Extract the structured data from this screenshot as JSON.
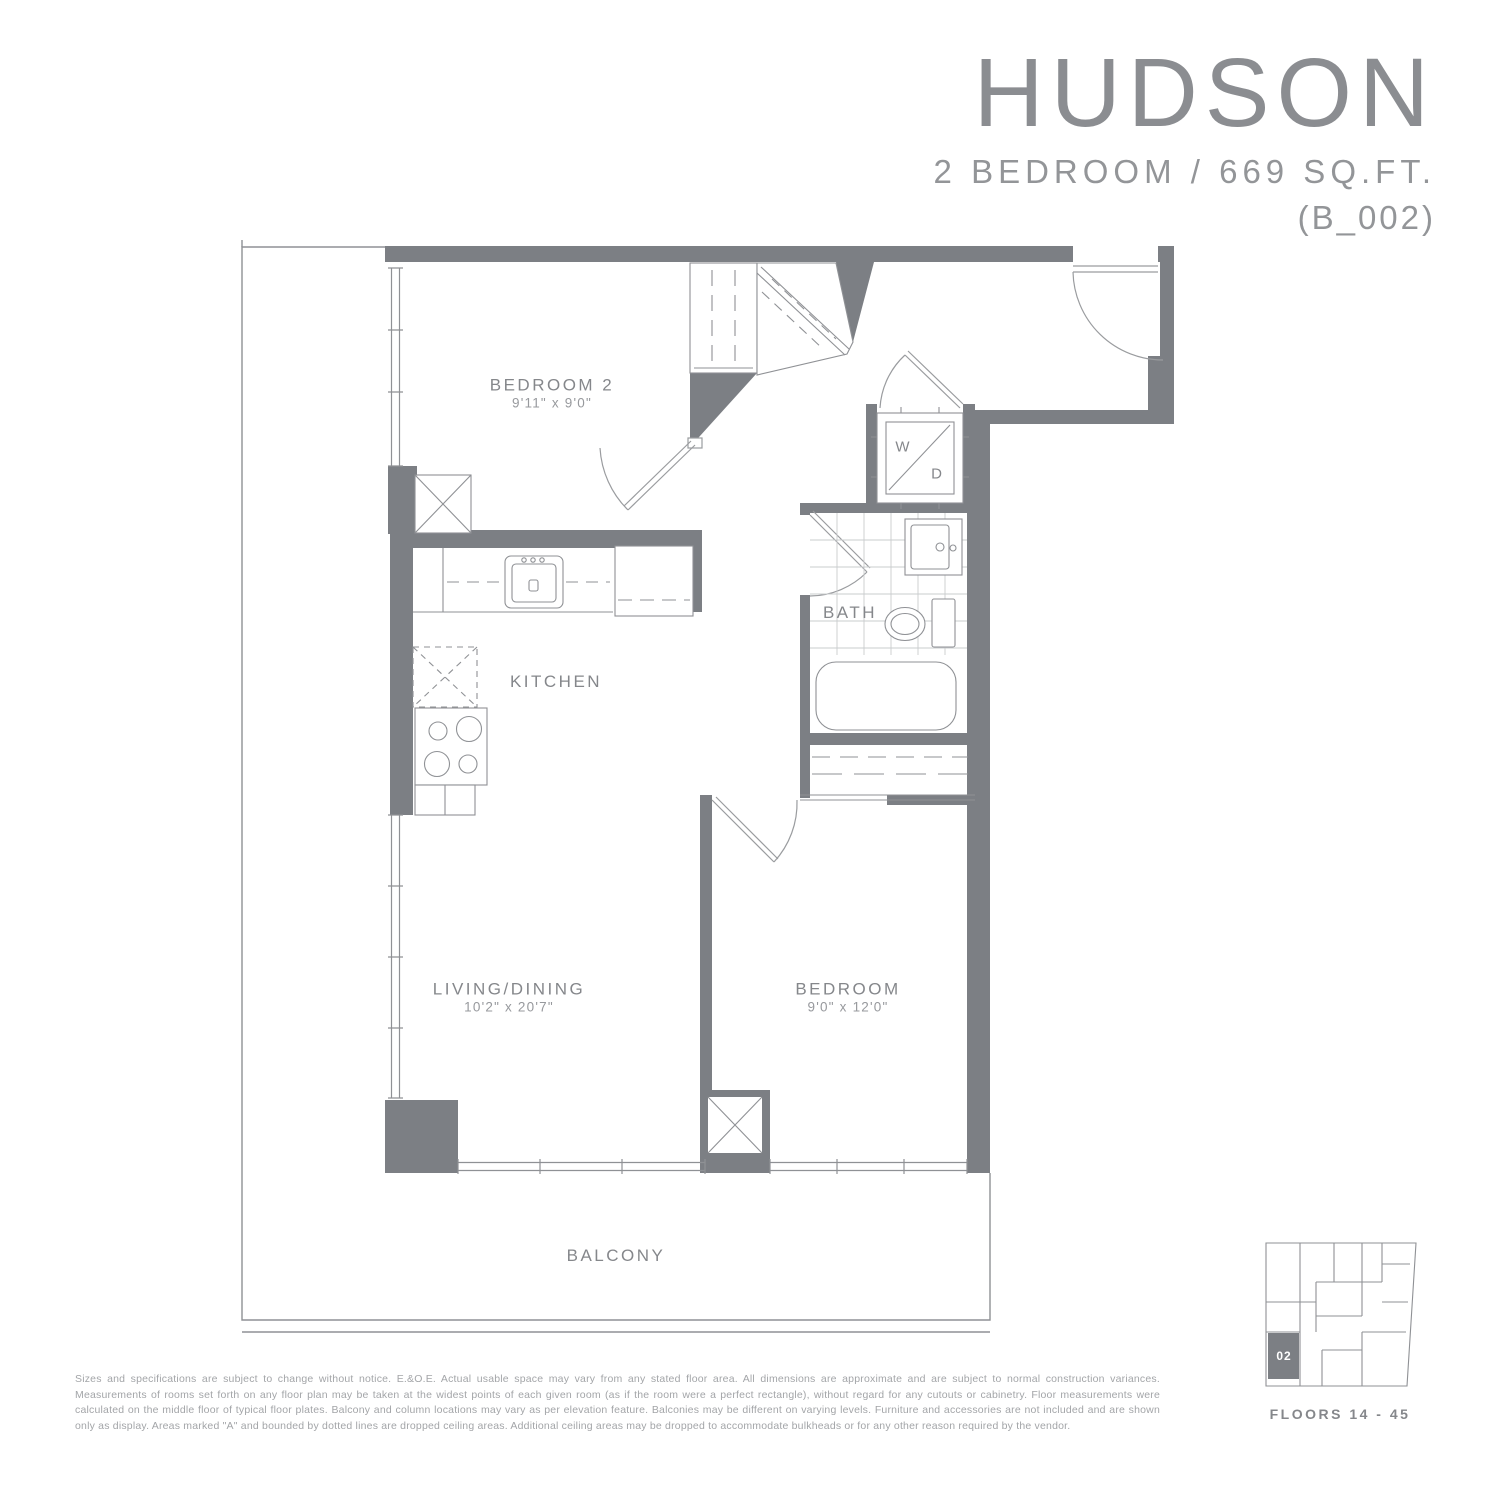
{
  "header": {
    "title": "HUDSON",
    "subtitle": "2 BEDROOM  /  669 SQ.FT.",
    "unit_code": "(B_002)"
  },
  "rooms": {
    "bedroom2": {
      "name": "BEDROOM 2",
      "dims": "9'11\" x 9'0\""
    },
    "kitchen": {
      "name": "KITCHEN"
    },
    "bath": {
      "name": "BATH"
    },
    "living": {
      "name": "LIVING/DINING",
      "dims": "10'2\" x 20'7\""
    },
    "bedroom": {
      "name": "BEDROOM",
      "dims": "9'0\" x 12'0\""
    },
    "balcony": {
      "name": "BALCONY"
    }
  },
  "appliances": {
    "washer": "W",
    "dryer": "D"
  },
  "keyplan": {
    "unit": "02",
    "floors": "FLOORS 14 - 45"
  },
  "disclaimer": "Sizes and specifications are subject to change without notice. E.&O.E. Actual usable space may vary from any stated floor area. All dimensions are approximate and are subject to normal construction variances. Measurements of rooms set forth on any floor plan may be taken at the widest points of each given room (as if the room were a perfect rectangle), without regard for any cutouts or cabinetry. Floor measurements were calculated on the middle floor of typical floor plates. Balcony and column locations may vary as per elevation feature. Balconies may be different on varying levels. Furniture and accessories are not included and are shown only as display. Areas marked \"A\" and bounded by dotted lines are dropped ceiling areas. Additional ceiling areas may be dropped to accommodate bulkheads or for any other reason required by the vendor.",
  "colors": {
    "wall": "#7c7f84",
    "line": "#8f9195",
    "tile": "#caccce",
    "accent_text": "#85878b"
  }
}
